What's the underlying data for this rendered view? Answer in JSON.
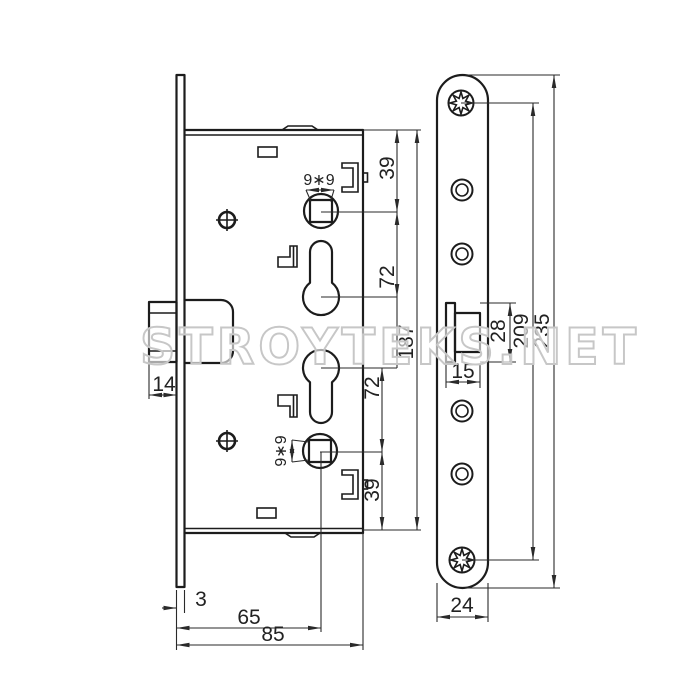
{
  "watermark": "STROYTEKS.NET",
  "drawing": {
    "type": "mortise-lock-technical-drawing",
    "views": [
      "lock-body-side-view",
      "faceplate-front-view"
    ],
    "dims": {
      "top_to_spindle": "39",
      "spindle_to_cylinder_upper": "72",
      "body_height": "187",
      "cylinder_to_spindle_lower": "72",
      "spindle_to_bottom": "39",
      "spindle_square": "9∗9",
      "latch_projection": "14",
      "faceplate_thickness": "3",
      "backset": "65",
      "body_depth": "85",
      "bolt_width": "15",
      "bolt_height": "28",
      "screw_centers": "209",
      "faceplate_length": "235",
      "faceplate_width": "24"
    }
  }
}
